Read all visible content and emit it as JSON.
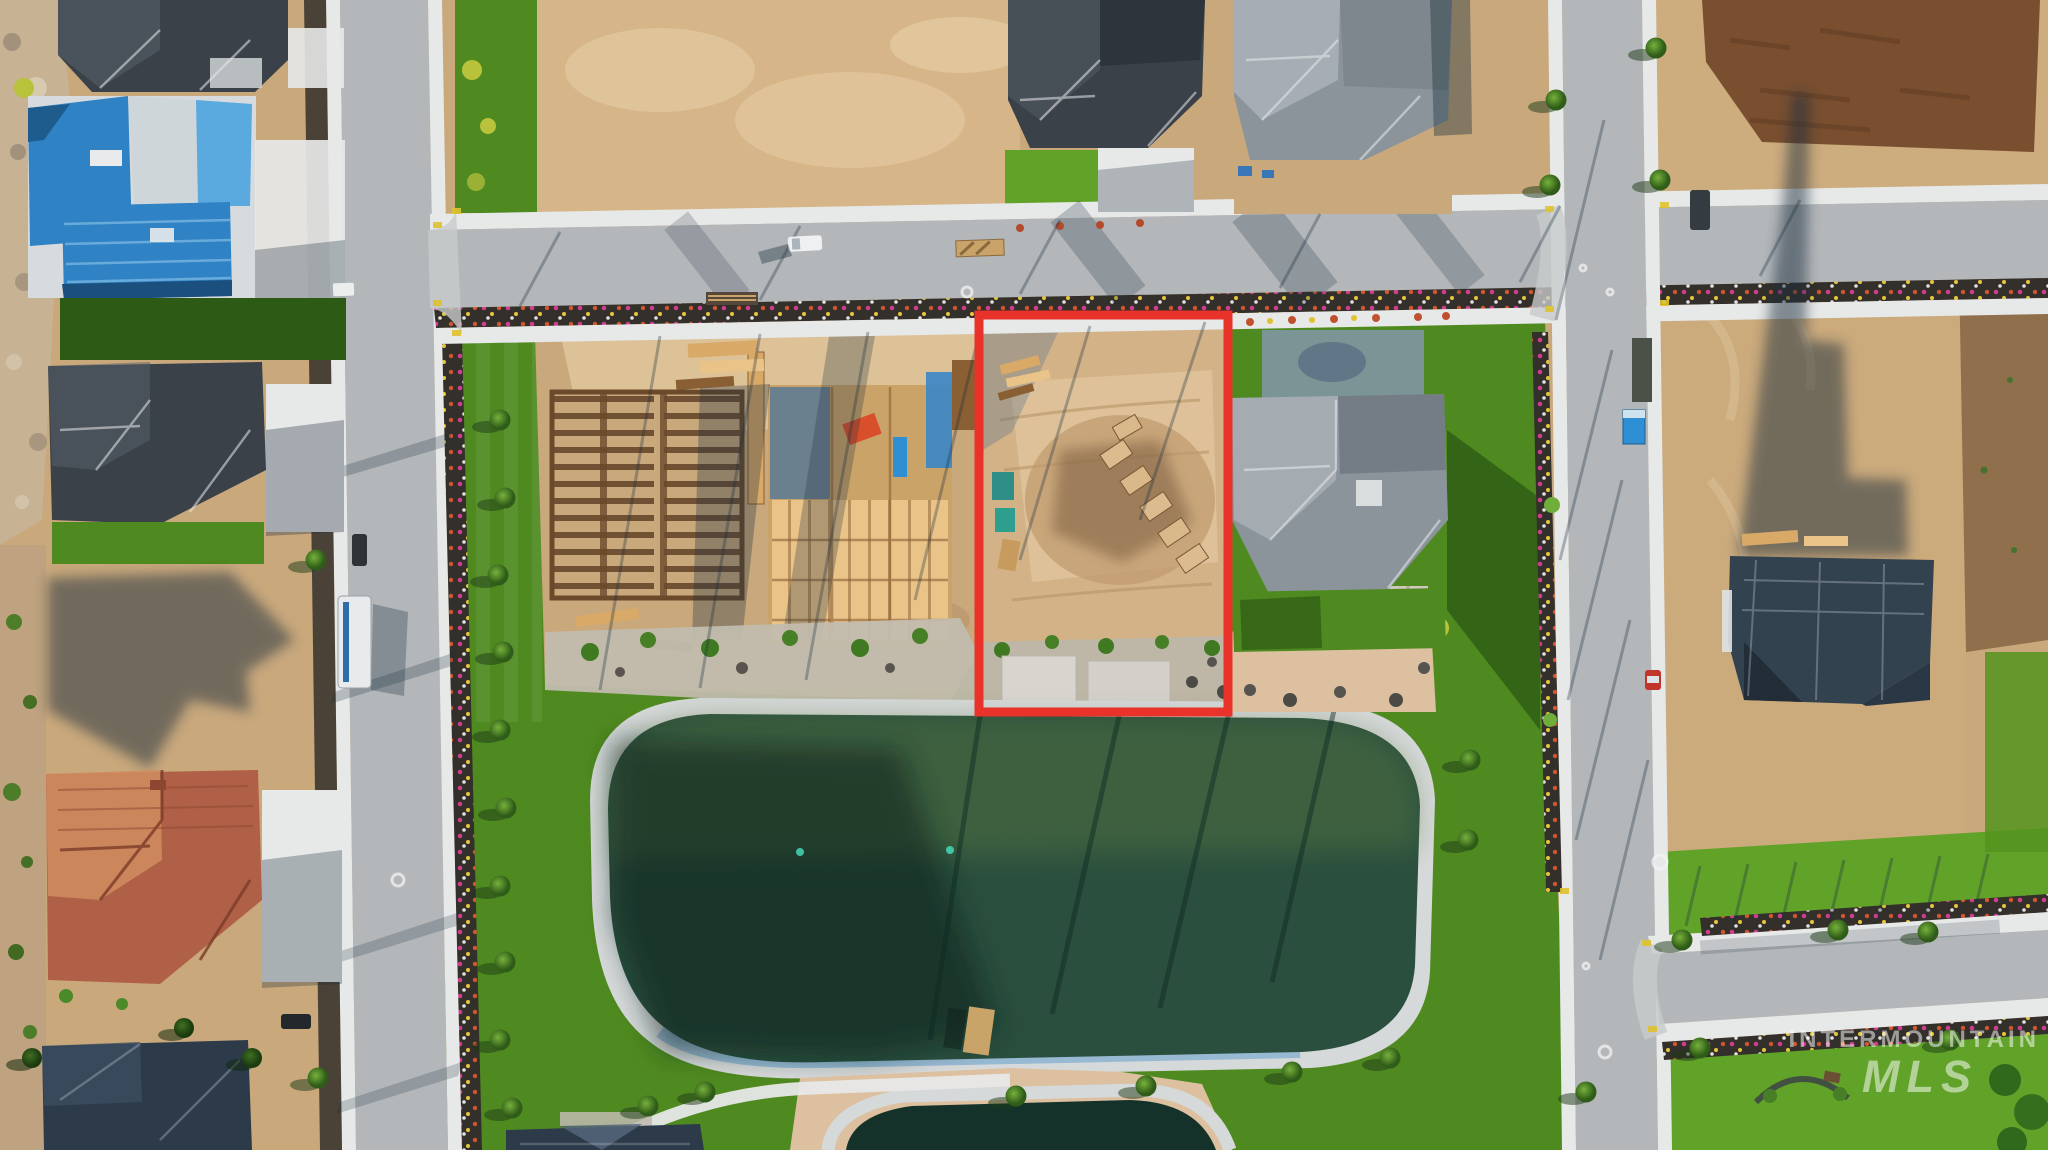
{
  "watermark": {
    "line1": "INTERMOUNTAIN",
    "line2": "MLS"
  },
  "boundary": {
    "color": "#e8322a"
  },
  "palette": {
    "boundary_red": "#e8322a",
    "asphalt": "#b3b7ba",
    "asphalt_light": "#c7cacb",
    "concrete": "#e7e8e8",
    "mulch": "#34302b",
    "grass": "#4f8a20",
    "grass_bright": "#61a228",
    "grass_dark": "#2d5a14",
    "dirt": "#c9a87c",
    "dirt_light": "#e2c89f",
    "dirt_dark": "#a8845b",
    "soil_dark": "#7a4f30",
    "rock_light": "#d6d9da",
    "rock_blue": "#93b7d2",
    "water": "#2a4f3e",
    "water_dark": "#14322a",
    "roof_charcoal": "#3a4148",
    "roof_charcoal_light": "#58626b",
    "roof_gray": "#8b949b",
    "roof_gray_light": "#aab2b8",
    "roof_blue": "#2f82c4",
    "roof_blue_light": "#5aa9df",
    "roof_navy": "#2c3a4a",
    "roof_tile": "#b06046",
    "roof_tile_light": "#d08d60",
    "wood": "#d9a967",
    "wood_dark": "#8a5f33",
    "wood_light": "#e9c387",
    "shadow": "#1c2f3d"
  }
}
